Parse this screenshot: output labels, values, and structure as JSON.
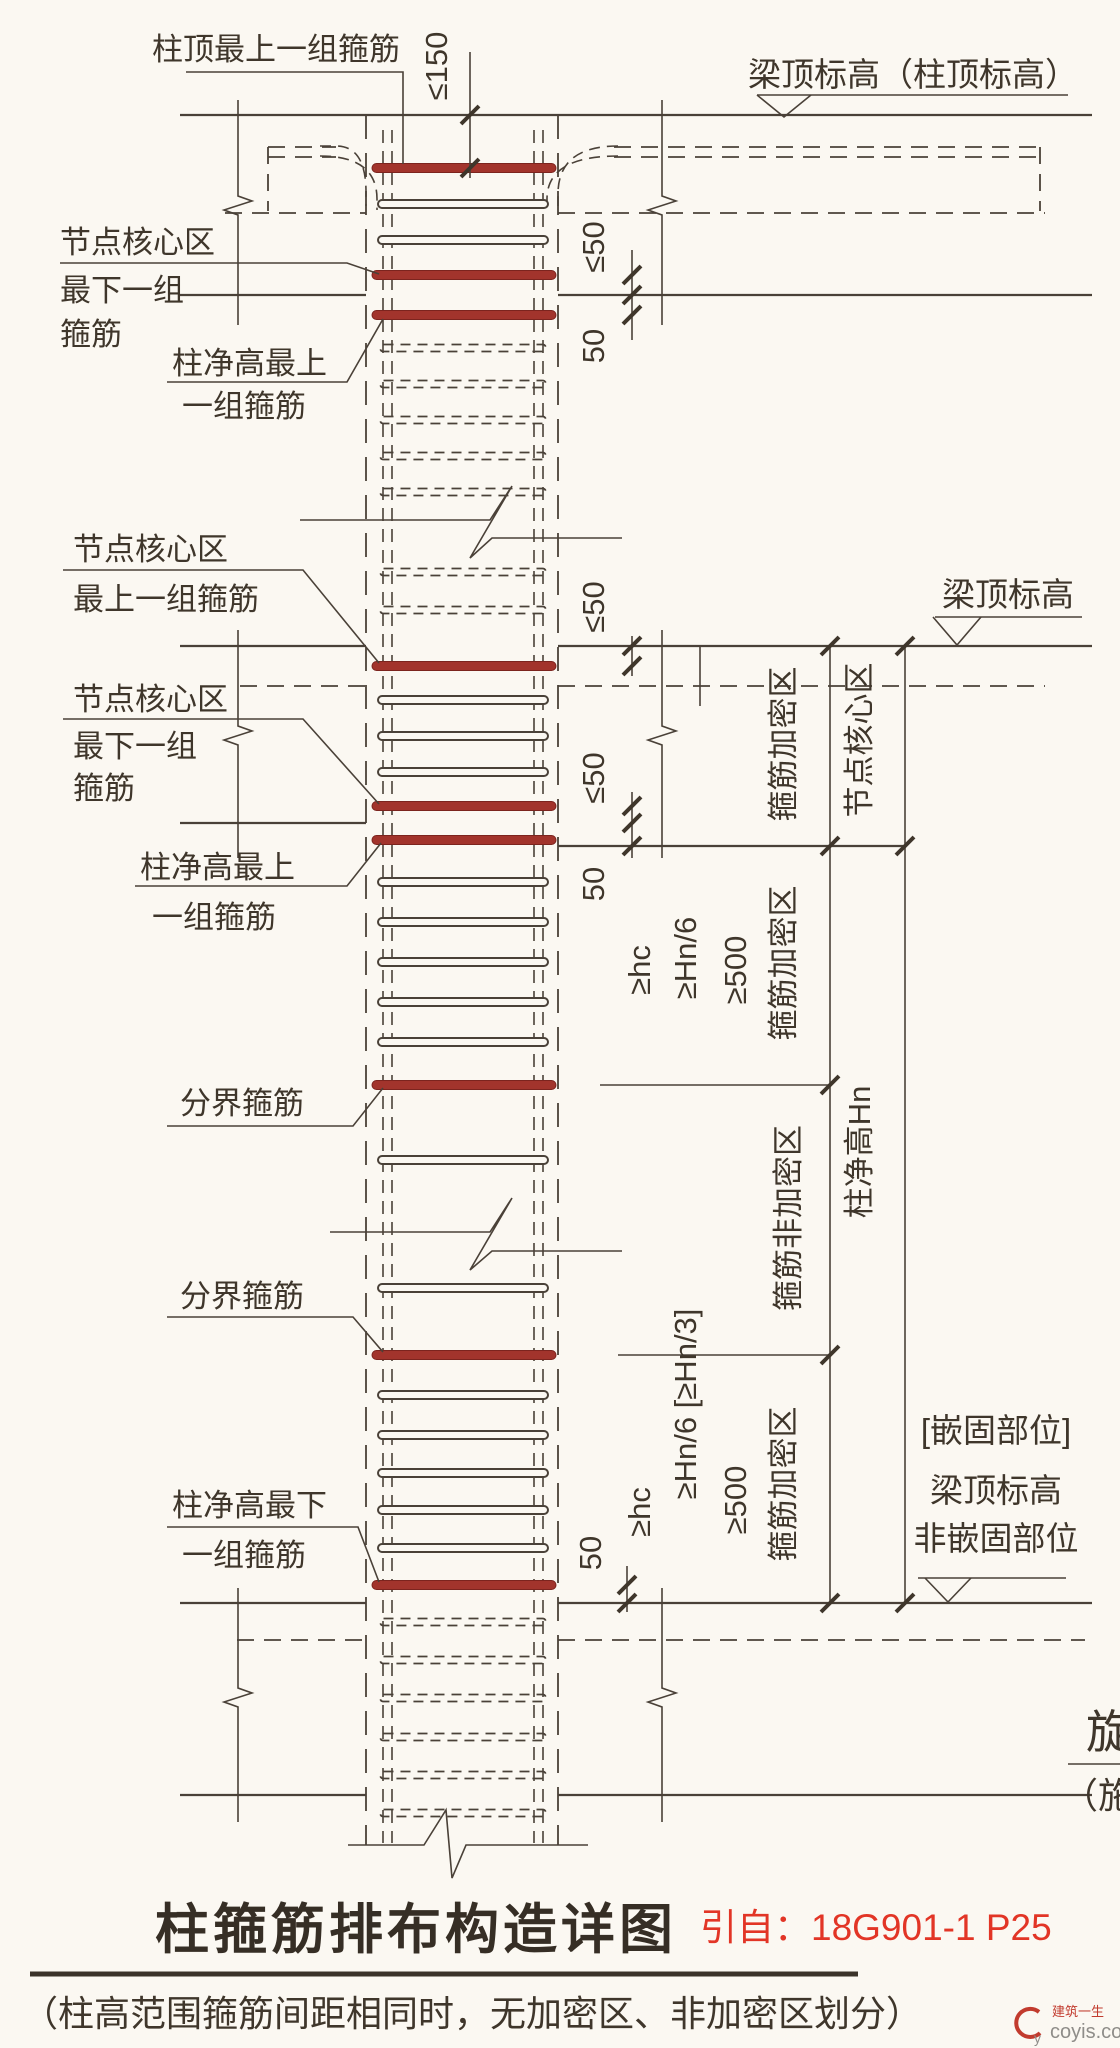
{
  "page": {
    "background": "#fbf8f2",
    "ink": "#4a4138",
    "stirrup_red": "#a2342c",
    "accent_red": "#e23526"
  },
  "labels": {
    "top_stirrup": "柱顶最上一组箍筋",
    "level_top": "梁顶标高（柱顶标高）",
    "jc1_l1": "节点核心区",
    "jc1_l2": "最下一组",
    "jc1_l3": "箍筋",
    "ct1_l1": "柱净高最上",
    "ct1_l2": "一组箍筋",
    "jc2_l1": "节点核心区",
    "jc2_l2": "最上一组箍筋",
    "jc3_l1": "节点核心区",
    "jc3_l2": "最下一组",
    "jc3_l3": "箍筋",
    "ct2_l1": "柱净高最上",
    "ct2_l2": "一组箍筋",
    "boundary1": "分界箍筋",
    "boundary2": "分界箍筋",
    "cb_l1": "柱净高最下",
    "cb_l2": "一组箍筋",
    "level_mid": "梁顶标高"
  },
  "dims": {
    "max150": "≤150",
    "max50_top": "≤50",
    "fifty_top": "50",
    "max50_mid1": "≤50",
    "max50_mid2": "≤50",
    "fifty_mid": "50",
    "fifty_bottom": "50",
    "hc_mid": "≥hc",
    "hn6_mid": "≥Hn/6",
    "f500_mid": "≥500",
    "hc_bot": "≥hc",
    "hn6_bot": "≥Hn/6 [≥Hn/3]",
    "f500_bot": "≥500"
  },
  "zones": {
    "dense_top": "箍筋加密区",
    "joint_core": "节点核心区",
    "dense_mid": "箍筋加密区",
    "non_dense": "箍筋非加密区",
    "clear_height": "柱净高Hn",
    "dense_bot": "箍筋加密区",
    "anchor_l1": "[嵌固部位]",
    "anchor_l2": "梁顶标高",
    "anchor_l3": "非嵌固部位"
  },
  "footer": {
    "title": "柱箍筋排布构造详图",
    "source": "引自：18G901-1 P25",
    "note": "（柱高范围箍筋间距相同时，无加密区、非加密区划分）"
  },
  "edge": {
    "partial1": "旋",
    "partial2": "（施"
  },
  "watermark": {
    "brand": "建筑一生",
    "site": "coyis.com"
  }
}
